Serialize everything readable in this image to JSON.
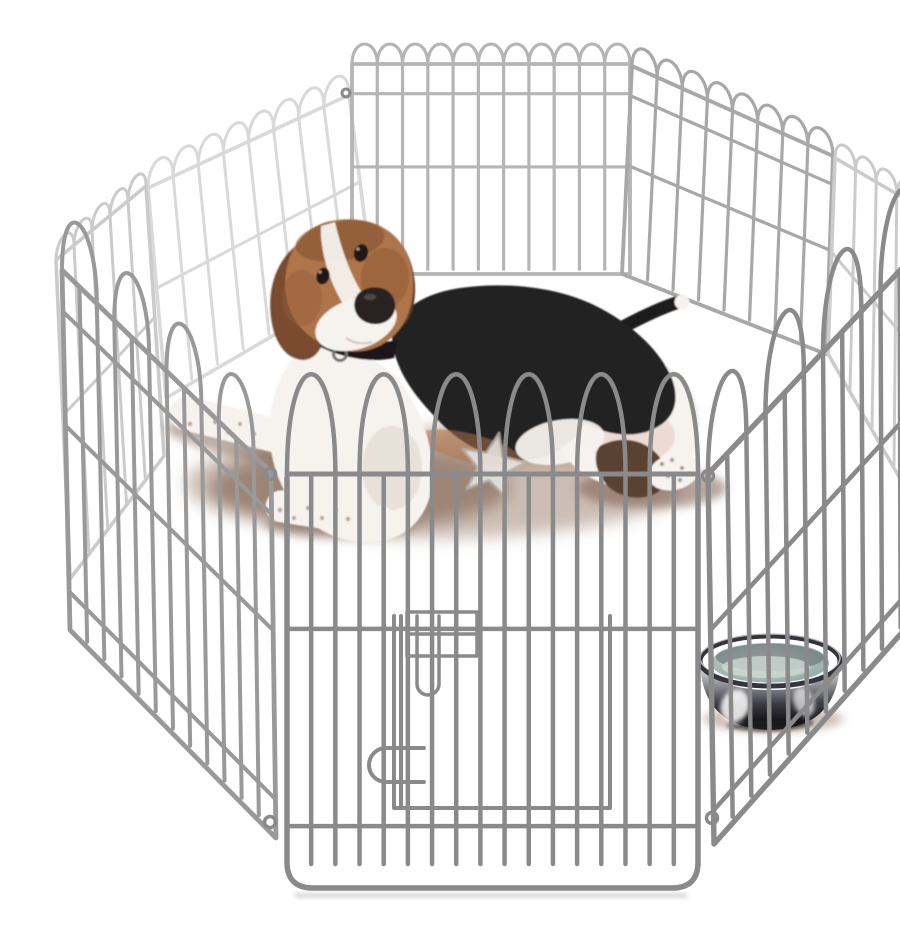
{
  "scene": {
    "title": "Beagle puppy in octagonal wire playpen",
    "description": "Product photo of an 8-panel silver metal wire exercise playpen arranged in an octagon on a white background. A tricolor beagle puppy lies inside looking at the camera, a stainless steel water bowl sits at the right, and a translucent star-shaped toy lies near the puppy's front paws. The front panel has a door with a latch plate, sliding bolt and handle.",
    "objects": {
      "puppy": "beagle puppy lying down, tan head, black saddle, white chest and paws, black collar",
      "playpen": "octagonal 8-panel wire exercise pen with arched loop tops",
      "door": "front panel swing door with latch plate, drop bolt and wire handle",
      "bowl": "stainless steel bowl with water",
      "toy": "translucent rubber star toy",
      "shadows": "soft warm shadows on white floor"
    }
  },
  "colors": {
    "background": "#ffffff",
    "wire_front": "#8a8a8a",
    "wire_front2": "#999999",
    "wire_mid": "#a8a8a8",
    "wire_back": "#b5b5b5",
    "wire_light": "#cbcbcb",
    "wire_xlight": "#d9d9d9",
    "dog_black": "#222124",
    "dog_white": "#f6f2ee",
    "dog_tan": "#ad7448",
    "dog_tan_dark": "#7c4e2e",
    "dog_ear": "#7a4b2d",
    "dog_ear_dark": "#5e3a22",
    "dog_nose": "#2b2121",
    "dog_pink": "#e3c2b8",
    "dog_speckle": "#a39a8e",
    "shadow_warm": "#9a7b67",
    "shadow_dark": "#6f4e3c",
    "bowl_rim": "#34343c",
    "water": "#a6bdb6",
    "water_light": "#cdd8d3",
    "chrome_hi": "#f2f2f4",
    "chrome_mid": "#9a9aa2",
    "chrome_dark": "#17171c",
    "toy": "#eceae6",
    "toy_edge": "#b5b3ae",
    "ground_shadow": "#c9c9c9"
  }
}
